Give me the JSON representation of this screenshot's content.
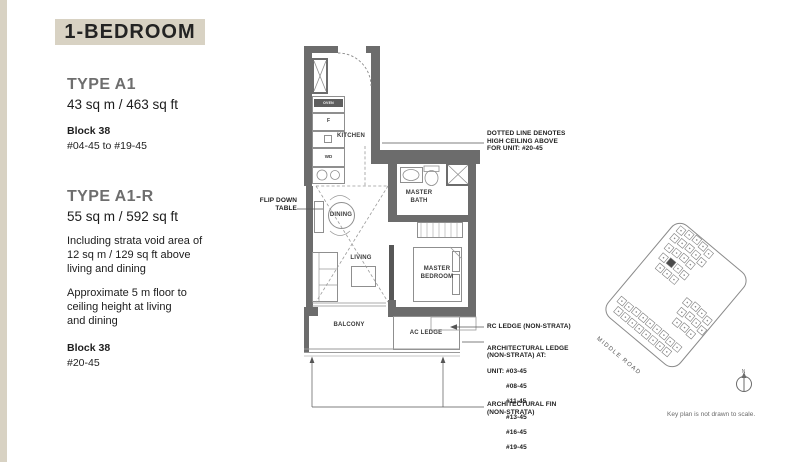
{
  "title": "1-BEDROOM",
  "left_panel": {
    "type_a1": {
      "name": "TYPE A1",
      "area": "43 sq m / 463 sq ft",
      "block": "Block 38",
      "units": "#04-45 to #19-45"
    },
    "type_a1r": {
      "name": "TYPE A1-R",
      "area": "55 sq m / 592 sq ft",
      "note1": "Including strata void area of\n12 sq m / 129 sq ft above\nliving and dining",
      "note2": "Approximate 5 m floor to\nceiling height at living\nand dining",
      "block": "Block 38",
      "units": "#20-45"
    }
  },
  "floorplan": {
    "rooms": {
      "kitchen": "KITCHEN",
      "dining": "DINING",
      "living": "LIVING",
      "balcony": "BALCONY",
      "master_bath": "MASTER\nBATH",
      "master_bedroom": "MASTER\nBEDROOM",
      "ac_ledge": "AC LEDGE"
    },
    "fixtures": {
      "fridge": "F",
      "washer_dryer": "WD",
      "oven": "OVEN"
    },
    "callouts": {
      "flip_down_table": "FLIP DOWN\nTABLE",
      "high_ceiling": "DOTTED LINE DENOTES\nHIGH CEILING ABOVE\nFOR UNIT: #20-45",
      "rc_ledge": "RC LEDGE (NON-STRATA)",
      "arch_ledge_title": "ARCHITECTURAL LEDGE\n(NON-STRATA) AT:",
      "arch_ledge_units": [
        "UNIT: #03-45",
        "#08-45",
        "#11-45",
        "#13-45",
        "#16-45",
        "#19-45"
      ],
      "arch_fin": "ARCHITECTURAL FIN\n(NON-STRATA)"
    }
  },
  "keyplan": {
    "road_label": "MIDDLE ROAD",
    "north_label": "N",
    "note": "Key plan is not drawn to scale."
  },
  "colors": {
    "accent_beige": "#d8d2c3",
    "wall_gray": "#6c6c6c",
    "line_gray": "#8f8f8f"
  }
}
